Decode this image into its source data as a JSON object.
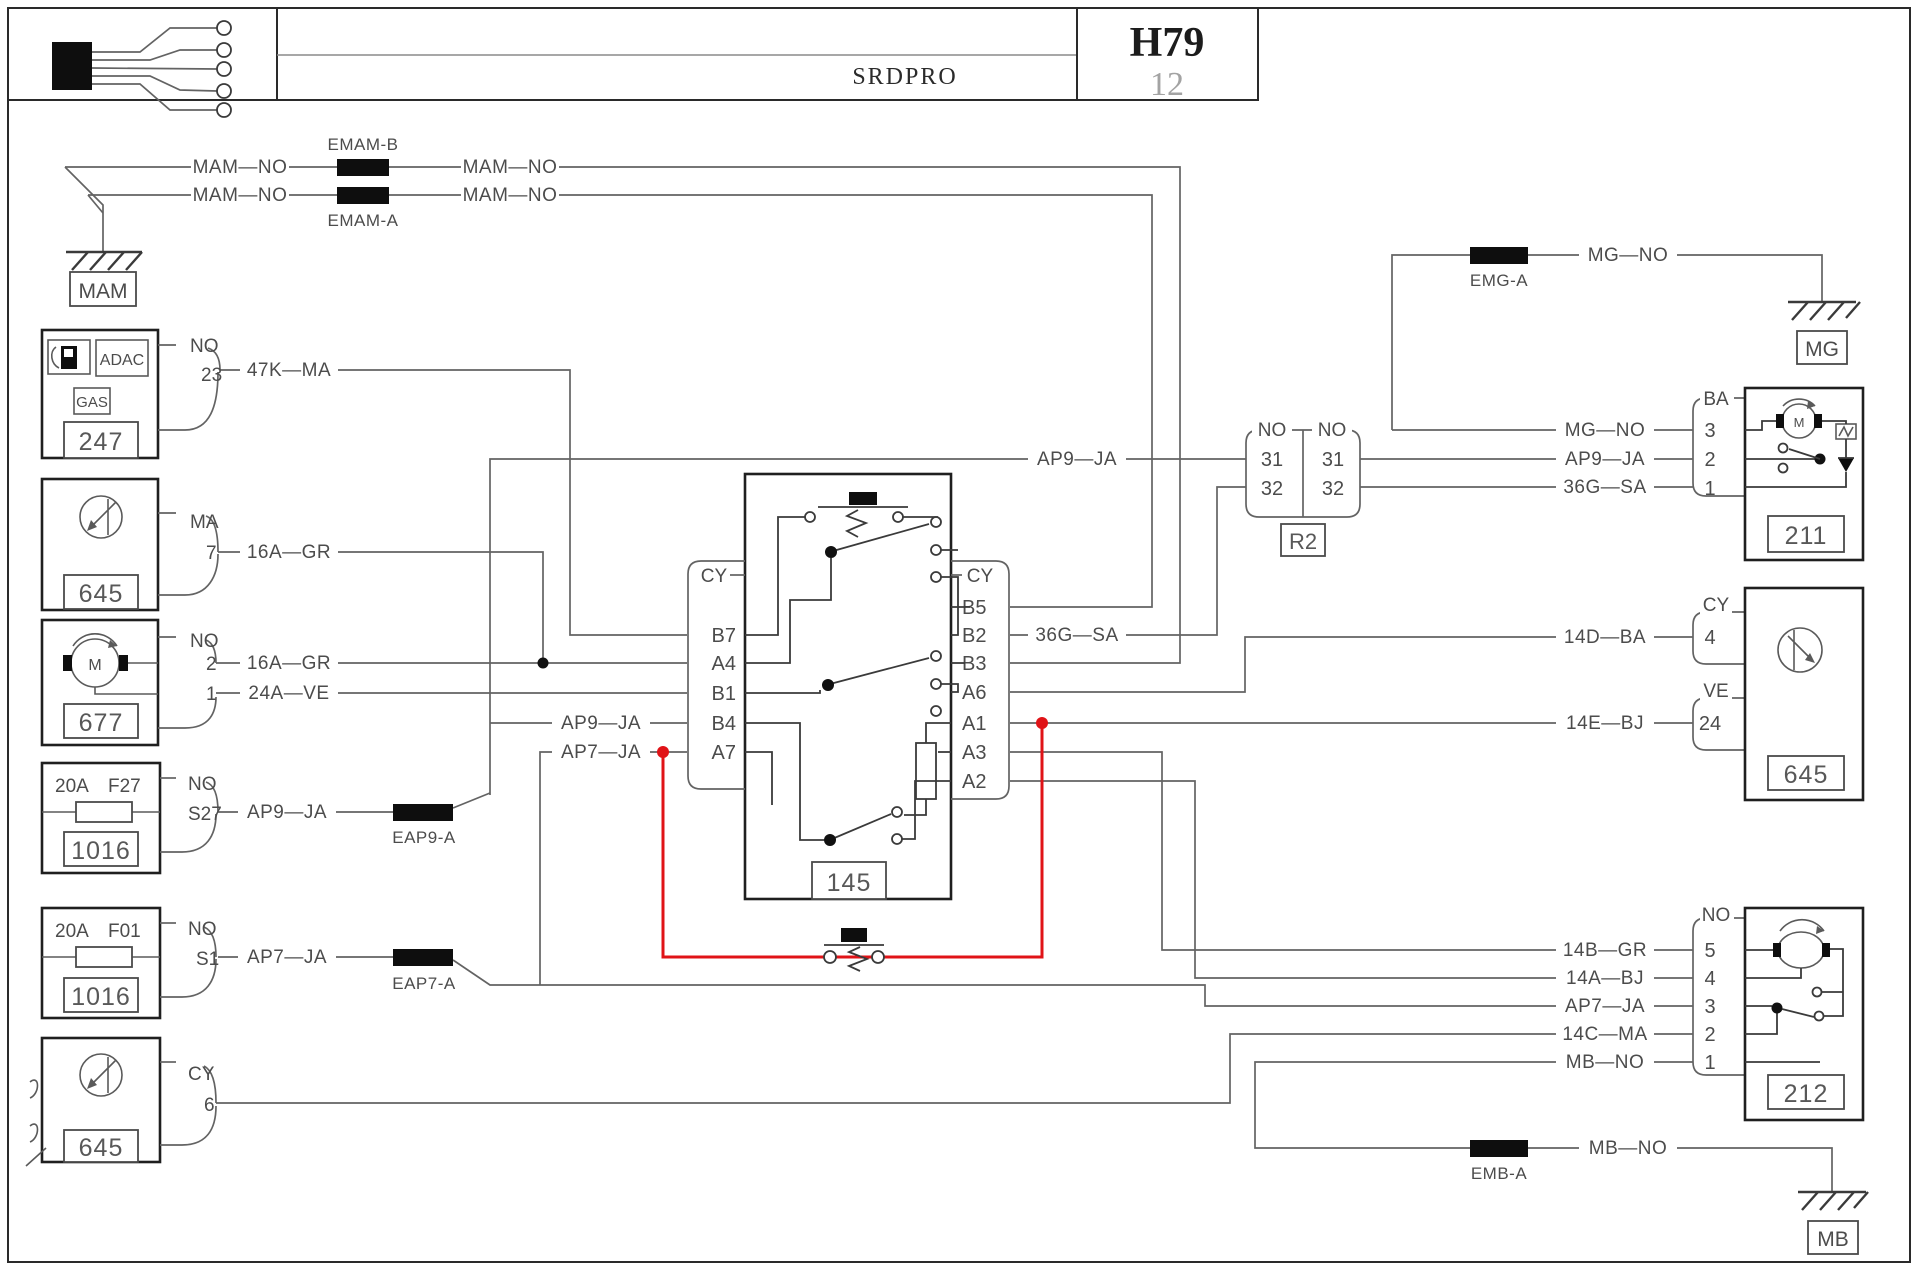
{
  "header": {
    "title": "SRDPRO",
    "code": "H79",
    "sheet": "12"
  },
  "labels": {
    "mam_no": "MAM—NO",
    "emam_b": "EMAM-B",
    "emam_a": "EMAM-A",
    "mam": "MAM",
    "no": "NO",
    "ma": "MA",
    "cy": "CY",
    "ba": "BA",
    "ve": "VE",
    "p23": "23",
    "p7": "7",
    "p2": "2",
    "p1": "1",
    "p3": "3",
    "p4": "4",
    "p5": "5",
    "p6": "6",
    "p24": "24",
    "p31": "31",
    "p32": "32",
    "s27": "S27",
    "s1": "S1",
    "w47k": "47K—MA",
    "w16a": "16A—GR",
    "w24a": "24A—VE",
    "ap9": "AP9—JA",
    "ap7": "AP7—JA",
    "w36g": "36G—SA",
    "mg_no": "MG—NO",
    "mb_no": "MB—NO",
    "w14b": "14B—GR",
    "w14a": "14A—BJ",
    "w14c": "14C—MA",
    "w14d": "14D—BA",
    "w14e": "14E—BJ",
    "eap9": "EAP9-A",
    "eap7": "EAP7-A",
    "emg": "EMG-A",
    "emb": "EMB-A",
    "mg": "MG",
    "mb": "MB",
    "amp20": "20A",
    "f27": "F27",
    "f01": "F01",
    "adac": "ADAC",
    "gas": "GAS",
    "m": "M",
    "n247": "247",
    "n645": "645",
    "n677": "677",
    "n1016": "1016",
    "n145": "145",
    "n211": "211",
    "n212": "212",
    "r2": "R2",
    "b7": "B7",
    "a4": "A4",
    "b1": "B1",
    "b4": "B4",
    "a7": "A7",
    "b5": "B5",
    "b2": "B2",
    "b3": "B3",
    "a6": "A6",
    "a1": "A1",
    "a3": "A3",
    "a2": "A2"
  },
  "colors": {
    "wire": "#636363",
    "outline": "#1f1f1f",
    "text": "#4c4c4c",
    "red": "#e01317",
    "splice": "#0e0e0e"
  }
}
